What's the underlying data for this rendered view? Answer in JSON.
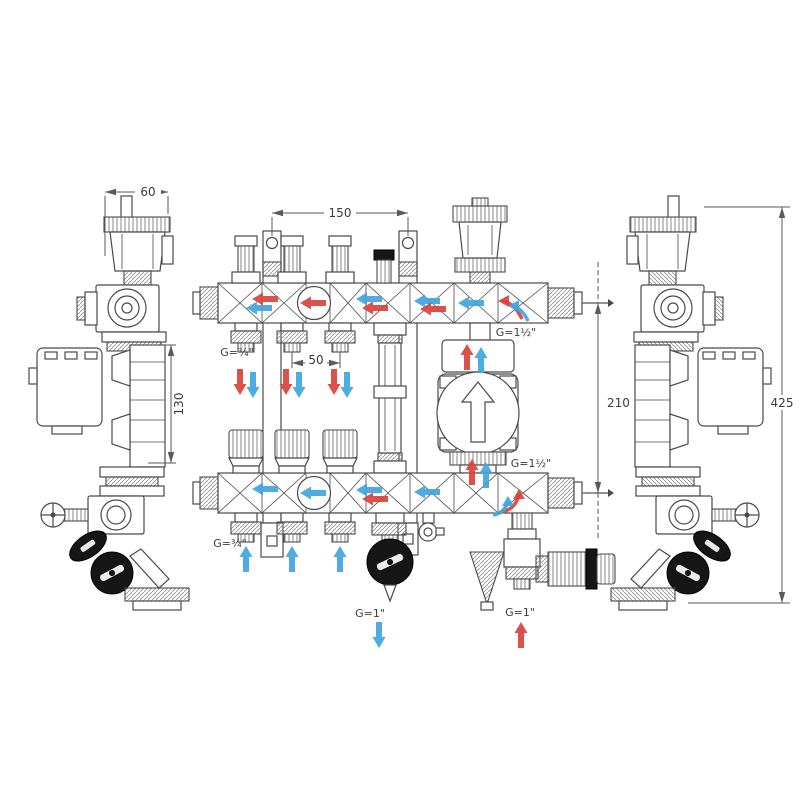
{
  "colors": {
    "line": "#4a4a4a",
    "dim": "#5a5a5a",
    "hot": "#d8433c",
    "cold": "#3fa5df",
    "black-part": "#161616"
  },
  "dimensions": {
    "depth": "60",
    "bracket_spacing": "150",
    "outlet_pitch": "50",
    "valve_offset": "130",
    "bar_distance": "210",
    "total_height": "425"
  },
  "connections": {
    "top_outlets": "G=¾\"",
    "bottom_outlets": "G=¾\"",
    "top_main": "G=1½\"",
    "bottom_main": "G=1½\"",
    "return_bottom": "G=1\"",
    "supply_bottom": "G=1\""
  }
}
